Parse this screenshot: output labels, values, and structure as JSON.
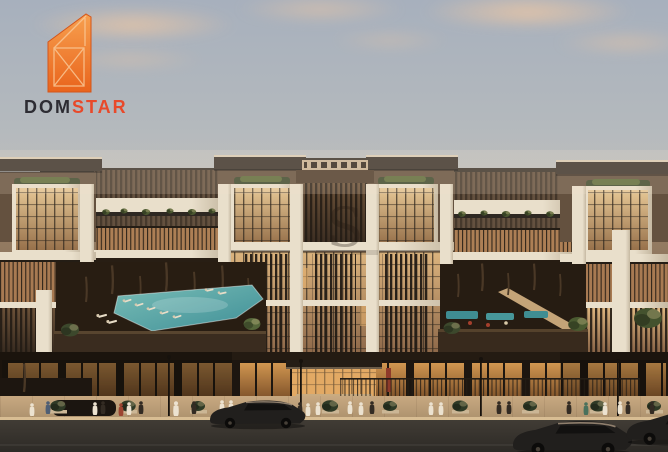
{
  "logo": {
    "word_primary": "DOM",
    "word_accent": "STAR",
    "mark_icon": "stylized-building-window-mark"
  },
  "watermark": {
    "letter": "S"
  },
  "palette": {
    "sky_top": "#a7b0bd",
    "sky_mid": "#c8c3bb",
    "sky_horizon": "#f2e2cb",
    "cloud_warm": "#e7c5a6",
    "roof_dark": "#3b332b",
    "roof_cap": "#dacbb4",
    "wall_bronze": "#64513f",
    "wall_tan": "#c1a689",
    "pier_white": "#e9dfcb",
    "pier_shade": "#c6b9a2",
    "glass_warm_hi": "#dcb47e",
    "glass_warm_lo": "#8a6547",
    "glass_dark_hi": "#6b5138",
    "glass_dark_lo": "#382b20",
    "mullion": "#2e261d",
    "fin": "#221b14",
    "foliage_dark": "#3c482c",
    "foliage_mid": "#5d6b3a",
    "foliage_olive": "#7b7542",
    "trunk": "#4a3826",
    "pool_hi": "#79bdb6",
    "pool_lo": "#3f8f97",
    "podium": "#241b12",
    "store_hi": "#e0a257",
    "store_lo": "#8a5a2e",
    "sidewalk_hi": "#c8a981",
    "sidewalk_lo": "#a98e6b",
    "curb": "#d8bd93",
    "road_hi": "#413c35",
    "road_lo": "#2d2a26",
    "car_body": "#211f1d",
    "robe": "#ece2d0",
    "figure_dark": "#332b23",
    "figure_red": "#9c4431",
    "figure_green": "#49715c",
    "figure_blue": "#4e5e74",
    "banner_red": "#8e3a2a",
    "logo_dom": "#2d2c33",
    "logo_star": "#e8492a",
    "logo_mark_top": "#f7a04f",
    "logo_mark_bottom": "#e9641c",
    "logo_mark_line": "#f9c795"
  }
}
